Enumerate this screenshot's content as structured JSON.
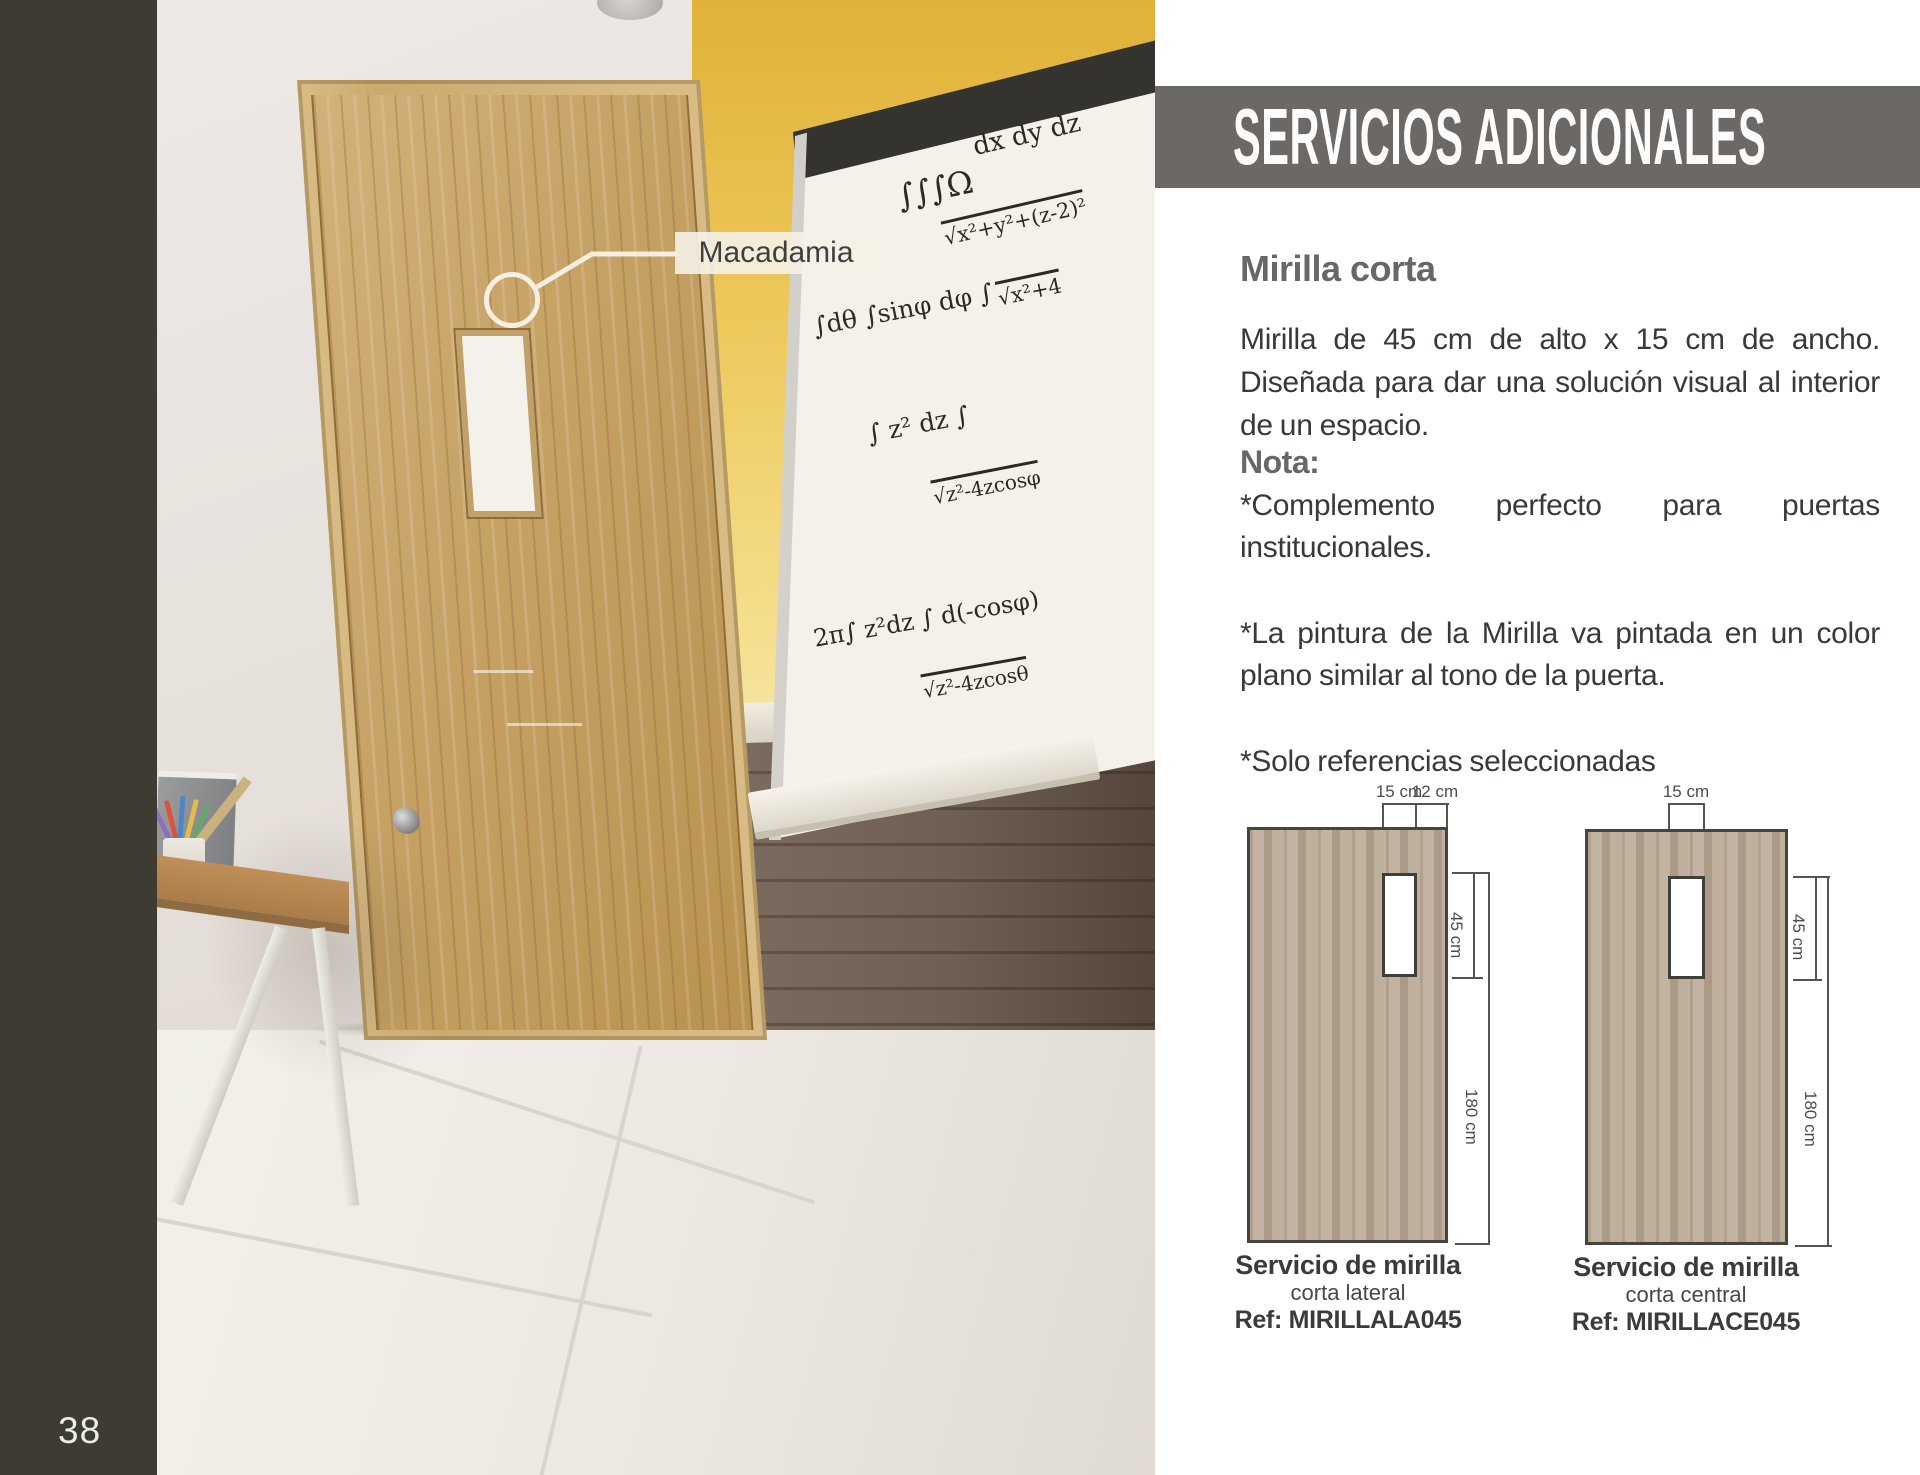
{
  "page": {
    "number": "38"
  },
  "header": {
    "title": "SERVICIOS ADICIONALES"
  },
  "photo": {
    "callout": "Macadamia",
    "whiteboard_lines": [
      "dx dy dz",
      "∫∫∫Ω",
      "√x²+y²+(z-2)²",
      "∫dθ ∫sinφ dφ ∫",
      "√x²+4",
      "∫ z² dz ∫",
      "√z²-4zcosφ",
      "2π∫ z²dz ∫ d(-cosφ)",
      "√z²-4zcosθ"
    ]
  },
  "content": {
    "section_title": "Mirilla corta",
    "description": "Mirilla de 45 cm de alto x 15 cm de ancho. Diseñada para dar una solución visual al interior de un espacio.",
    "note_title": "Nota:",
    "note1": "*Complemento perfecto para puertas institucionales.",
    "note2": "*La pintura de la Mirilla va pintada en un color plano similar al tono de la puerta.",
    "note3": "*Solo referencias seleccionadas"
  },
  "diagrams": {
    "left": {
      "dim_width": "15 cm",
      "dim_edge": "12 cm",
      "dim_window": "45 cm",
      "dim_height": "180 cm",
      "caption": "Servicio de mirilla",
      "subcaption": "corta lateral",
      "ref": "Ref: MIRILLALA045"
    },
    "right": {
      "dim_width": "15 cm",
      "dim_window": "45 cm",
      "dim_height": "180 cm",
      "caption": "Servicio de mirilla",
      "subcaption": "corta central",
      "ref": "Ref: MIRILLACE045"
    }
  },
  "colors": {
    "banner_gray": "#6B6866",
    "margin_dark": "#3E3B33",
    "door_wood": "#C9A468",
    "wall_yellow": "#EECB5F"
  }
}
